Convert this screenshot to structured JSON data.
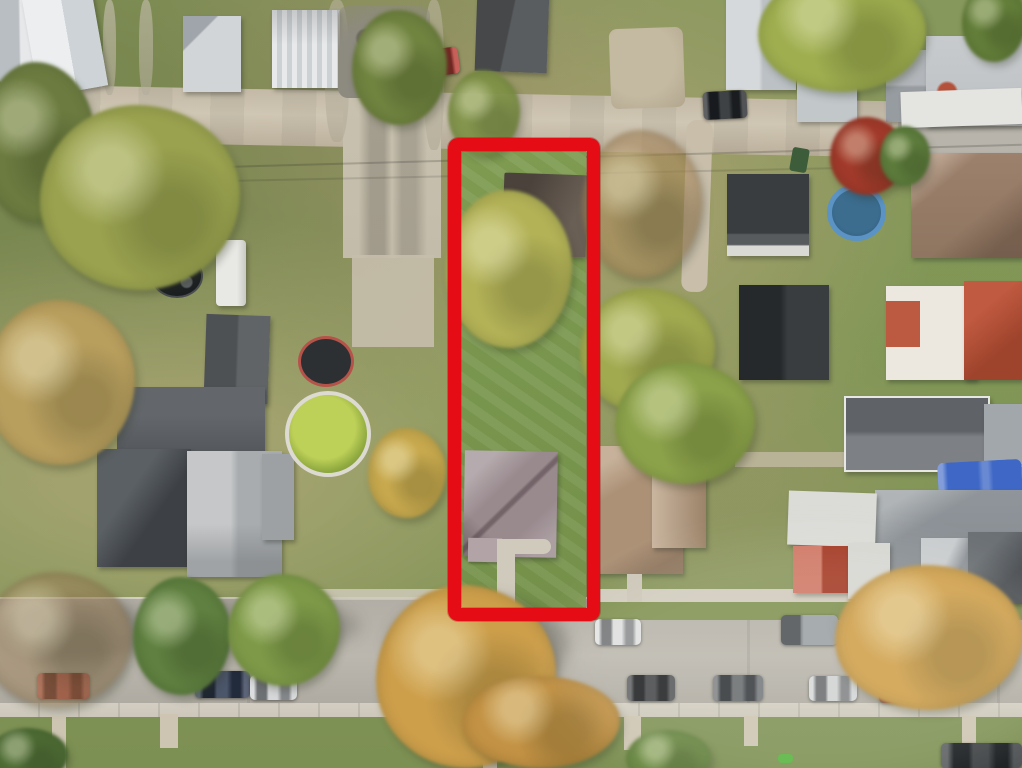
{
  "scene": {
    "type": "aerial-photograph",
    "subject": "overhead drone view of a residential neighborhood block in autumn",
    "annotation": "thick red rectangle outlining one deep narrow property lot",
    "visible_text": "none"
  },
  "overlay": {
    "label": "property boundary rectangle",
    "color": "#e60c16",
    "border_px": 13,
    "left": 448,
    "top": 138,
    "width": 152,
    "height": 483
  },
  "subject_lot": {
    "contents": [
      "dark detached garage at rear",
      "large yellow-green tree",
      "striped mown lawn",
      "mauve hip-roof house",
      "curved front walkway to street"
    ]
  },
  "streets": {
    "top": "gravel rear alley running horizontally",
    "bottom": "paved residential street with parked cars, curbs and sidewalks"
  },
  "objects": {
    "parked_vehicles_visible": 14,
    "pools": [
      "green algae above-ground pool",
      "small covered round pool",
      "blue kiddie pool"
    ],
    "trampolines": 2,
    "camper_trailer": 1,
    "blue_tarp": 1,
    "red_shed_roof": 1
  },
  "palette": {
    "grass": "#85985b",
    "street_asphalt": "#b4b0a7",
    "alley_gravel": "#c7bda9",
    "sidewalk_concrete": "#d2cdc1",
    "subject_house_roof": "#998a8e",
    "subject_garage_roof": "#55493f",
    "neighbor_roof_tan": "#ac9176",
    "left_house_roof_dark": "#45494d",
    "left_house_roof_light": "#c0c2c3",
    "pool_green_water": "#b5cb52",
    "kiddie_pool_blue": "#5a93c4",
    "tarp_blue": "#3f68c6",
    "red_maple": "#a23a2b",
    "autumn_gold": "#cd9f4b",
    "tree_yellow_green": "#aeb156",
    "red_shed_roof": "#bf4930",
    "boundary_red": "#e60c16"
  }
}
